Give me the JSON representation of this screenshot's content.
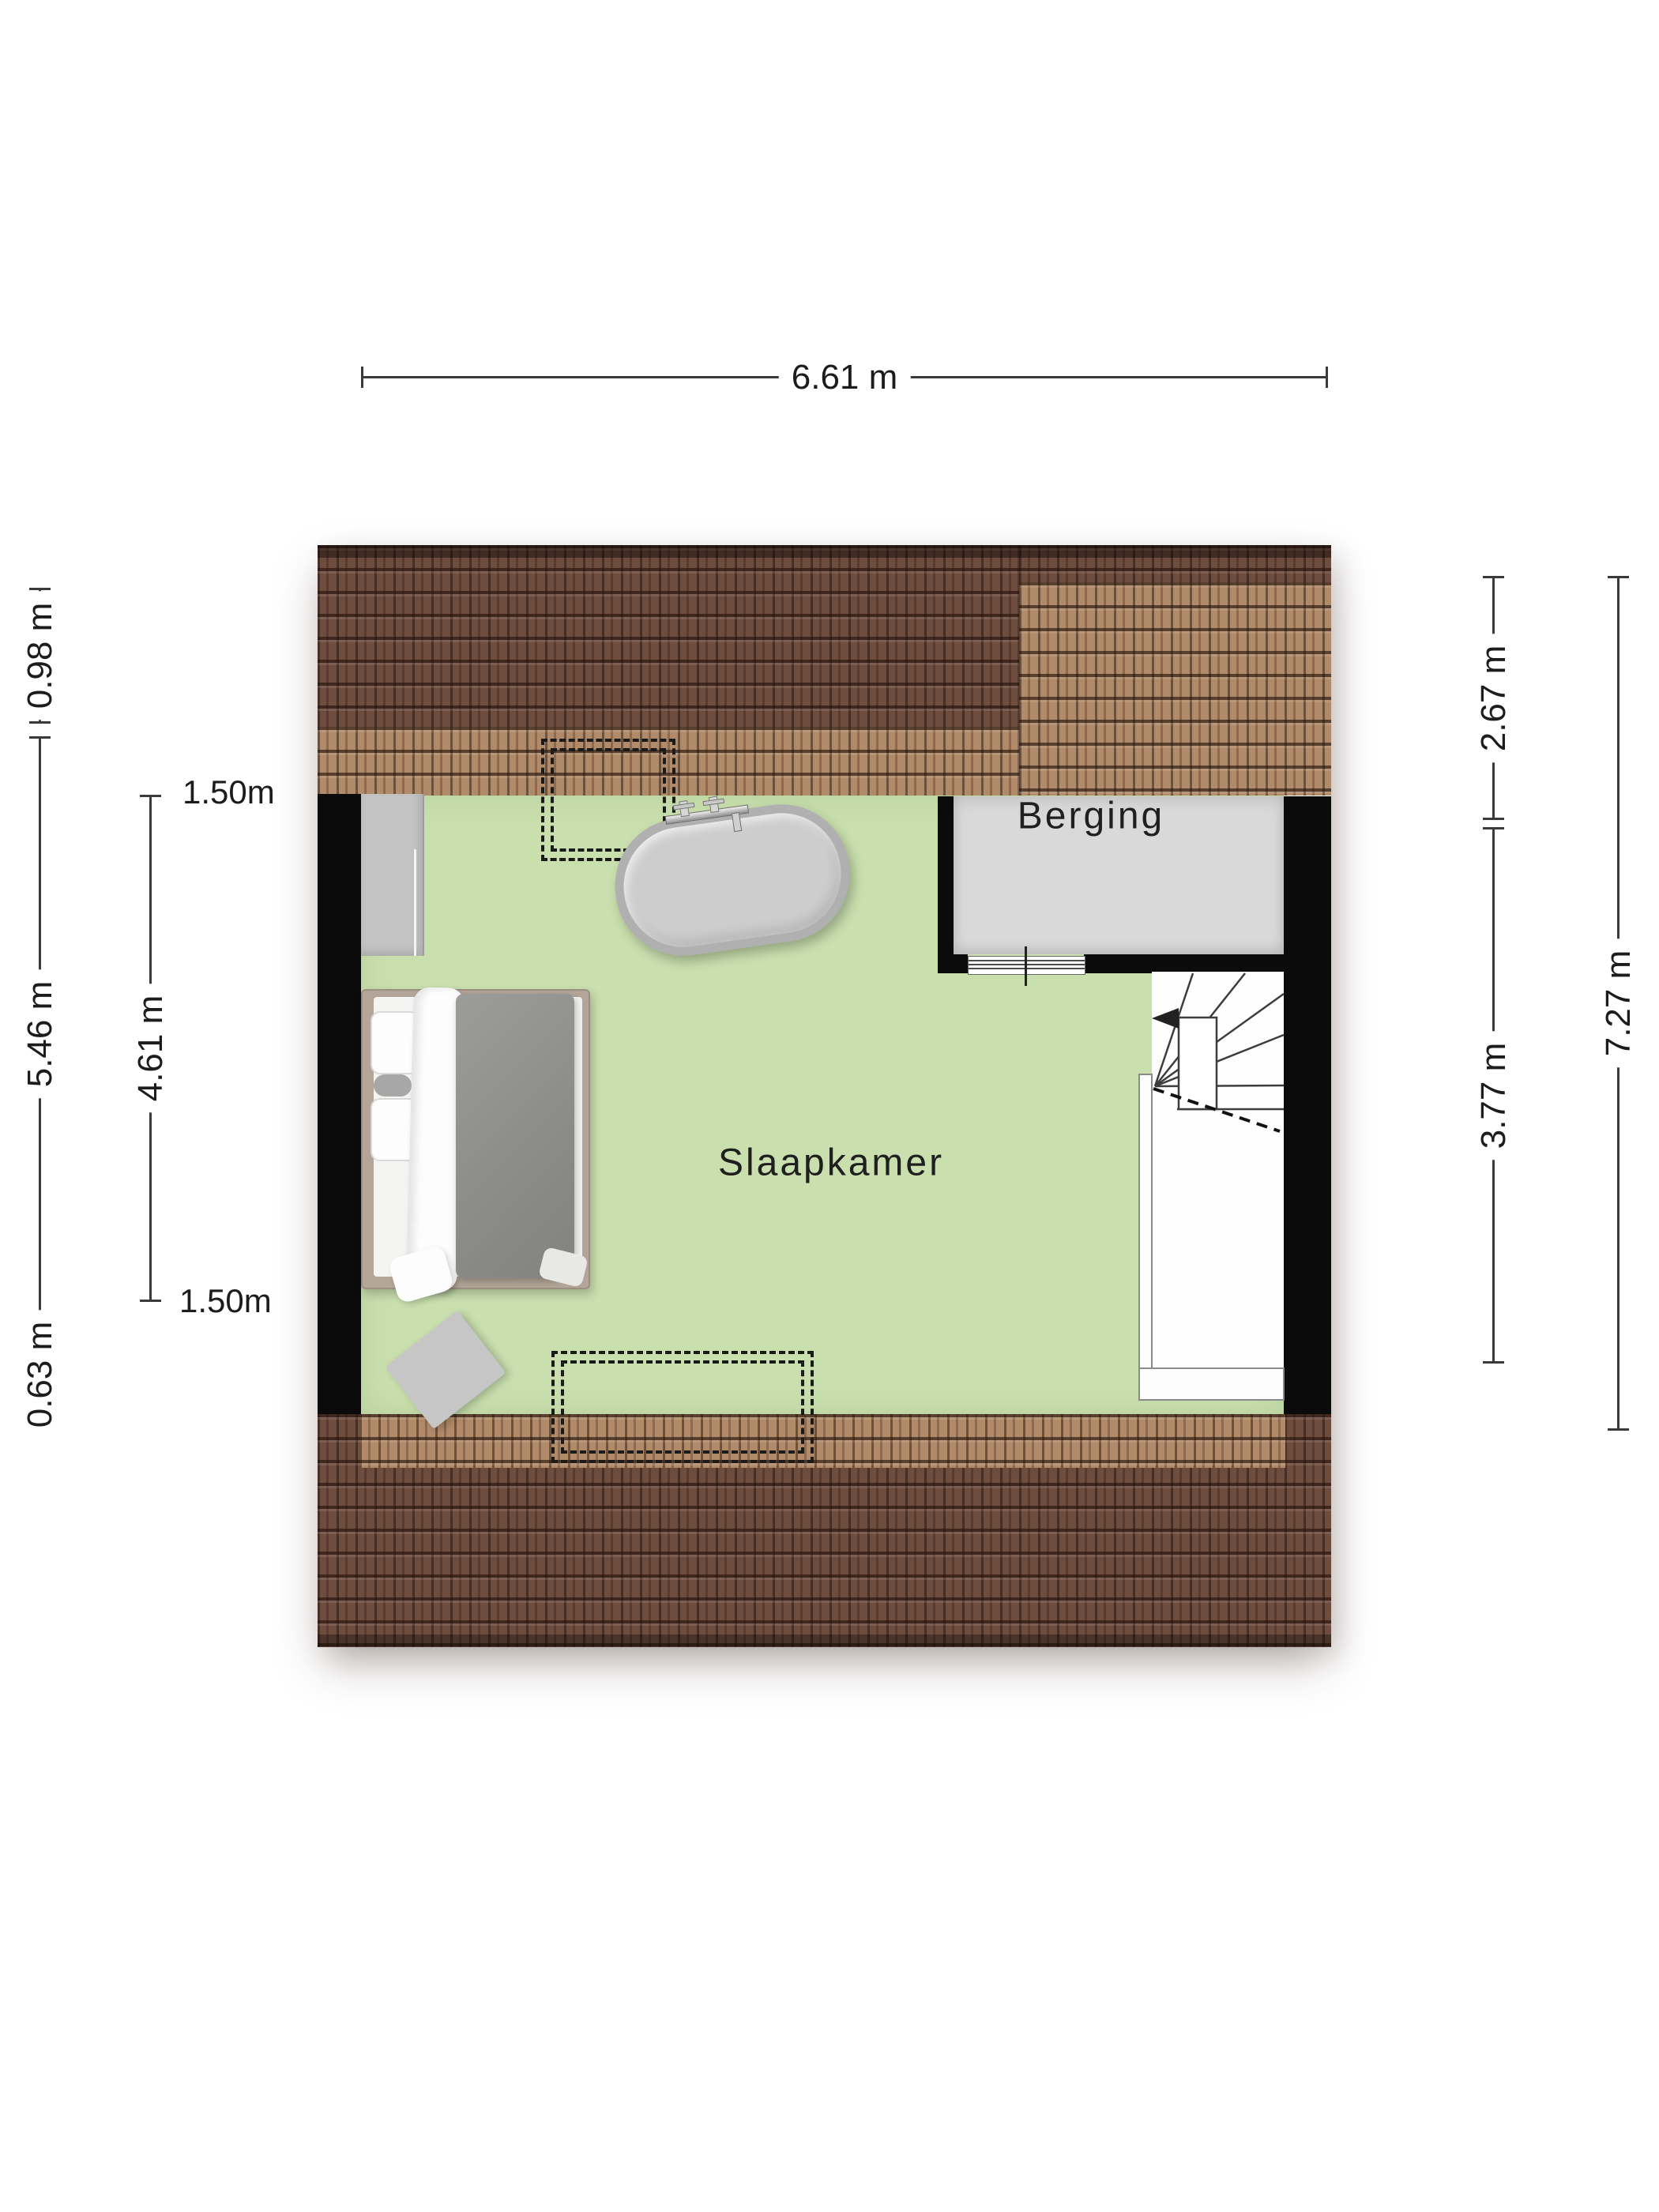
{
  "plan": {
    "rooms": [
      {
        "id": "slaapkamer",
        "label": "Slaapkamer"
      },
      {
        "id": "berging",
        "label": "Berging"
      }
    ],
    "icons": [
      {
        "name": "double-bed"
      },
      {
        "name": "bathtub"
      },
      {
        "name": "wardrobe"
      },
      {
        "name": "rug"
      },
      {
        "name": "winder-staircase"
      },
      {
        "name": "stairs-up-arrow"
      },
      {
        "name": "dormer-dashed-outline-top"
      },
      {
        "name": "dormer-dashed-outline-bottom"
      }
    ]
  },
  "dimensions": {
    "top": {
      "label": "6.61 m"
    },
    "left_outer": {
      "segments": [
        {
          "label": "0.98 m"
        },
        {
          "label": "5.46 m"
        },
        {
          "label": "0.63 m"
        }
      ]
    },
    "left_inner": {
      "span_label": "4.61 m",
      "top_marker": "1.50m",
      "bottom_marker": "1.50m"
    },
    "right_inner": {
      "segments": [
        {
          "label": "2.67 m"
        },
        {
          "label": "3.77 m"
        }
      ]
    },
    "right_outer": {
      "label": "7.27 m"
    }
  },
  "colors": {
    "bedroom_floor": "#c9dfae",
    "storage_floor": "#d9d9d9",
    "wall": "#0b0b0b",
    "roof_dark": "#6e4c3e",
    "roof_light": "#b18a69",
    "dimension_line": "#3a3a3a",
    "text": "#1c1c1c"
  }
}
